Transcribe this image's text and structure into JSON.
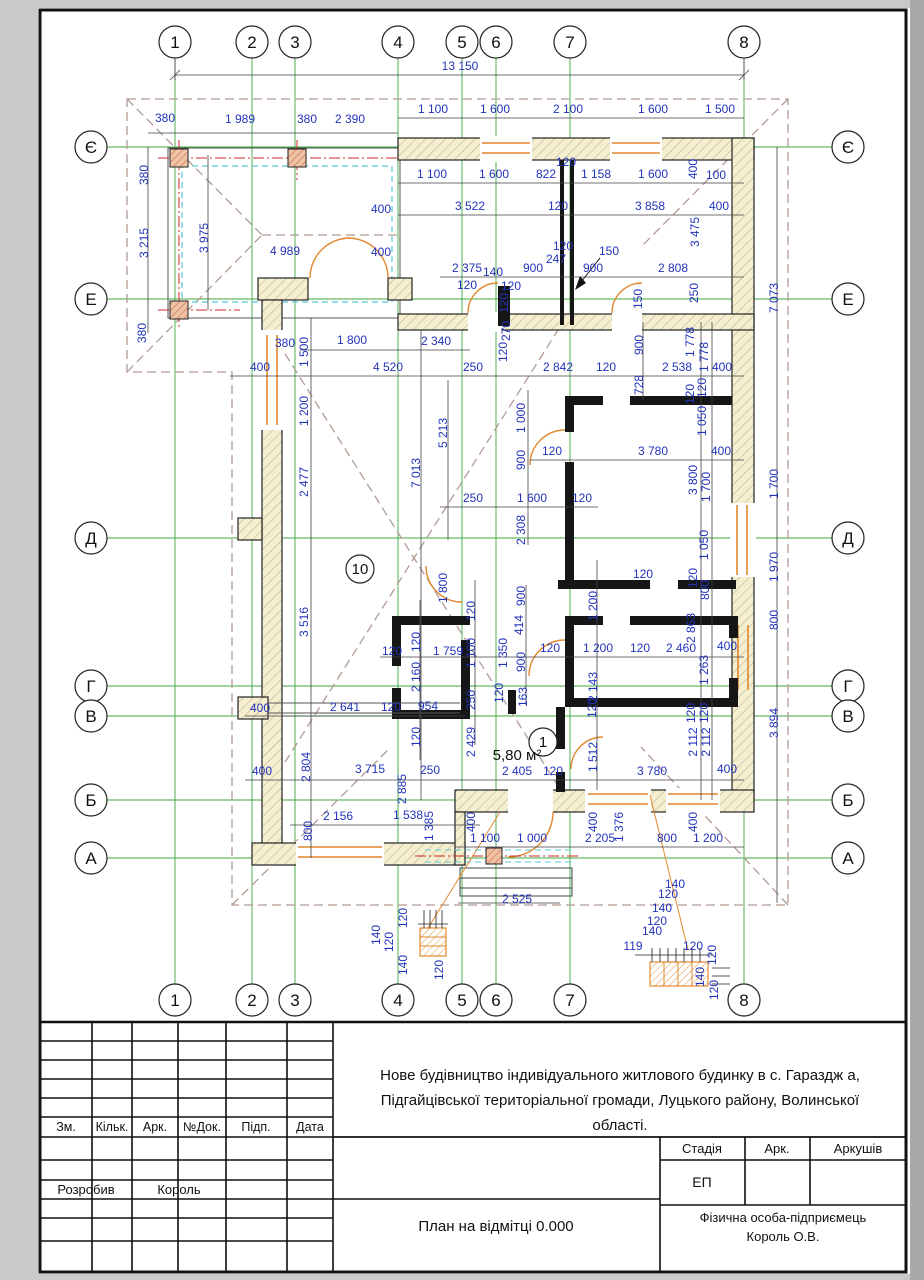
{
  "plan": {
    "colors": {
      "dim": "#2233bb",
      "grid": "#3faa3f",
      "roof_dash": "#b39b94",
      "orange": "#e2882f",
      "cyan": "#5bc8d8",
      "red": "#cc2a2a",
      "wall_fill": "#f6efcf",
      "line": "#222222"
    },
    "axes_x": [
      {
        "label": "1",
        "x": 175
      },
      {
        "label": "2",
        "x": 252
      },
      {
        "label": "3",
        "x": 295
      },
      {
        "label": "4",
        "x": 398
      },
      {
        "label": "5",
        "x": 462
      },
      {
        "label": "6",
        "x": 496
      },
      {
        "label": "7",
        "x": 570
      },
      {
        "label": "8",
        "x": 744
      }
    ],
    "axes_y": [
      {
        "label": "Є",
        "y": 147
      },
      {
        "label": "Е",
        "y": 299
      },
      {
        "label": "Д",
        "y": 538
      },
      {
        "label": "Г",
        "y": 686
      },
      {
        "label": "В",
        "y": 716
      },
      {
        "label": "Б",
        "y": 800
      },
      {
        "label": "А",
        "y": 858
      }
    ],
    "top_circle_y": 42,
    "bottom_circle_y": 1000,
    "left_circle_x": 91,
    "right_circle_x": 848,
    "circle_r": 16,
    "rooms": [
      {
        "num": "10",
        "x": 360,
        "y": 569
      },
      {
        "num": "1",
        "x": 543,
        "y": 742
      }
    ],
    "area_note": {
      "t": "5,80 м²",
      "x": 517,
      "y": 760
    },
    "leader_note": "150",
    "dims": [
      {
        "t": "13 150",
        "x": 460,
        "y": 70
      },
      {
        "t": "380",
        "x": 165,
        "y": 122
      },
      {
        "t": "1 989",
        "x": 240,
        "y": 123
      },
      {
        "t": "380",
        "x": 307,
        "y": 123
      },
      {
        "t": "2 390",
        "x": 350,
        "y": 123
      },
      {
        "t": "1 100",
        "x": 433,
        "y": 113
      },
      {
        "t": "1 600",
        "x": 495,
        "y": 113
      },
      {
        "t": "2 100",
        "x": 568,
        "y": 113
      },
      {
        "t": "1 600",
        "x": 653,
        "y": 113
      },
      {
        "t": "1 500",
        "x": 720,
        "y": 113
      },
      {
        "t": "1 100",
        "x": 432,
        "y": 178
      },
      {
        "t": "1 600",
        "x": 494,
        "y": 178
      },
      {
        "t": "822",
        "x": 546,
        "y": 178
      },
      {
        "t": "120",
        "x": 566,
        "y": 166
      },
      {
        "t": "1 158",
        "x": 596,
        "y": 178
      },
      {
        "t": "1 600",
        "x": 653,
        "y": 178
      },
      {
        "t": "400",
        "x": 697,
        "y": 169,
        "r": 1
      },
      {
        "t": "100",
        "x": 716,
        "y": 179
      },
      {
        "t": "3 522",
        "x": 470,
        "y": 210
      },
      {
        "t": "120",
        "x": 558,
        "y": 210
      },
      {
        "t": "3 858",
        "x": 650,
        "y": 210
      },
      {
        "t": "400",
        "x": 719,
        "y": 210
      },
      {
        "t": "3 475",
        "x": 699,
        "y": 232,
        "r": 1
      },
      {
        "t": "380",
        "x": 148,
        "y": 175,
        "r": 1
      },
      {
        "t": "3 215",
        "x": 148,
        "y": 243,
        "r": 1
      },
      {
        "t": "3 975",
        "x": 208,
        "y": 238,
        "r": 1
      },
      {
        "t": "380",
        "x": 146,
        "y": 333,
        "r": 1
      },
      {
        "t": "4 989",
        "x": 285,
        "y": 255
      },
      {
        "t": "400",
        "x": 381,
        "y": 213
      },
      {
        "t": "400",
        "x": 381,
        "y": 256
      },
      {
        "t": "2 375",
        "x": 467,
        "y": 272
      },
      {
        "t": "140",
        "x": 493,
        "y": 276
      },
      {
        "t": "120",
        "x": 467,
        "y": 289
      },
      {
        "t": "120",
        "x": 511,
        "y": 290
      },
      {
        "t": "900",
        "x": 533,
        "y": 272
      },
      {
        "t": "247",
        "x": 556,
        "y": 263
      },
      {
        "t": "120",
        "x": 563,
        "y": 250
      },
      {
        "t": "150",
        "x": 609,
        "y": 255
      },
      {
        "t": "900",
        "x": 593,
        "y": 272
      },
      {
        "t": "2 808",
        "x": 673,
        "y": 272
      },
      {
        "t": "250",
        "x": 698,
        "y": 293,
        "r": 1
      },
      {
        "t": "150",
        "x": 642,
        "y": 299,
        "r": 1
      },
      {
        "t": "7 073",
        "x": 778,
        "y": 298,
        "r": 1
      },
      {
        "t": "120",
        "x": 508,
        "y": 303,
        "r": 1
      },
      {
        "t": "270",
        "x": 510,
        "y": 331,
        "r": 1
      },
      {
        "t": "120",
        "x": 507,
        "y": 352,
        "r": 1
      },
      {
        "t": "380",
        "x": 285,
        "y": 347
      },
      {
        "t": "1 800",
        "x": 352,
        "y": 344
      },
      {
        "t": "2 340",
        "x": 436,
        "y": 345
      },
      {
        "t": "1 500",
        "x": 308,
        "y": 352,
        "r": 1
      },
      {
        "t": "400",
        "x": 260,
        "y": 371
      },
      {
        "t": "4 520",
        "x": 388,
        "y": 371
      },
      {
        "t": "250",
        "x": 473,
        "y": 371
      },
      {
        "t": "2 842",
        "x": 558,
        "y": 371
      },
      {
        "t": "120",
        "x": 606,
        "y": 371
      },
      {
        "t": "2 538",
        "x": 677,
        "y": 371
      },
      {
        "t": "400",
        "x": 722,
        "y": 371
      },
      {
        "t": "900",
        "x": 643,
        "y": 345,
        "r": 1
      },
      {
        "t": "728",
        "x": 643,
        "y": 385,
        "r": 1
      },
      {
        "t": "1 778",
        "x": 694,
        "y": 342,
        "r": 1
      },
      {
        "t": "1 778",
        "x": 708,
        "y": 357,
        "r": 1
      },
      {
        "t": "1 200",
        "x": 308,
        "y": 411,
        "r": 1
      },
      {
        "t": "2 477",
        "x": 308,
        "y": 482,
        "r": 1
      },
      {
        "t": "1 000",
        "x": 525,
        "y": 418,
        "r": 1
      },
      {
        "t": "900",
        "x": 525,
        "y": 460,
        "r": 1
      },
      {
        "t": "5 213",
        "x": 447,
        "y": 433,
        "r": 1
      },
      {
        "t": "7 013",
        "x": 420,
        "y": 473,
        "r": 1
      },
      {
        "t": "120",
        "x": 694,
        "y": 394,
        "r": 1
      },
      {
        "t": "120",
        "x": 706,
        "y": 388,
        "r": 1
      },
      {
        "t": "1 050",
        "x": 706,
        "y": 421,
        "r": 1
      },
      {
        "t": "120",
        "x": 552,
        "y": 455
      },
      {
        "t": "3 780",
        "x": 653,
        "y": 455
      },
      {
        "t": "400",
        "x": 721,
        "y": 455
      },
      {
        "t": "3 800",
        "x": 697,
        "y": 480,
        "r": 1
      },
      {
        "t": "1 700",
        "x": 710,
        "y": 487,
        "r": 1
      },
      {
        "t": "1 700",
        "x": 778,
        "y": 484,
        "r": 1
      },
      {
        "t": "250",
        "x": 473,
        "y": 502
      },
      {
        "t": "1 600",
        "x": 532,
        "y": 502
      },
      {
        "t": "120",
        "x": 582,
        "y": 502
      },
      {
        "t": "2 308",
        "x": 525,
        "y": 530,
        "r": 1
      },
      {
        "t": "1 050",
        "x": 708,
        "y": 545,
        "r": 1
      },
      {
        "t": "1 970",
        "x": 778,
        "y": 567,
        "r": 1
      },
      {
        "t": "120",
        "x": 697,
        "y": 578,
        "r": 1
      },
      {
        "t": "800",
        "x": 709,
        "y": 590,
        "r": 1
      },
      {
        "t": "3 516",
        "x": 308,
        "y": 622,
        "r": 1
      },
      {
        "t": "1 800",
        "x": 447,
        "y": 588,
        "r": 1
      },
      {
        "t": "120",
        "x": 475,
        "y": 611,
        "r": 1
      },
      {
        "t": "900",
        "x": 525,
        "y": 596,
        "r": 1
      },
      {
        "t": "1 200",
        "x": 597,
        "y": 606,
        "r": 1
      },
      {
        "t": "120",
        "x": 643,
        "y": 578
      },
      {
        "t": "800",
        "x": 778,
        "y": 620,
        "r": 1
      },
      {
        "t": "2 863",
        "x": 695,
        "y": 628,
        "r": 1
      },
      {
        "t": "414",
        "x": 523,
        "y": 625,
        "r": 1
      },
      {
        "t": "1 350",
        "x": 507,
        "y": 653,
        "r": 1
      },
      {
        "t": "900",
        "x": 525,
        "y": 662,
        "r": 1
      },
      {
        "t": "1 100",
        "x": 475,
        "y": 653,
        "r": 1
      },
      {
        "t": "120",
        "x": 420,
        "y": 642,
        "r": 1
      },
      {
        "t": "1 759",
        "x": 448,
        "y": 655
      },
      {
        "t": "120",
        "x": 392,
        "y": 655
      },
      {
        "t": "2 160",
        "x": 420,
        "y": 677,
        "r": 1
      },
      {
        "t": "120",
        "x": 550,
        "y": 652
      },
      {
        "t": "1 200",
        "x": 598,
        "y": 652
      },
      {
        "t": "120",
        "x": 640,
        "y": 652
      },
      {
        "t": "2 460",
        "x": 681,
        "y": 652
      },
      {
        "t": "400",
        "x": 727,
        "y": 650
      },
      {
        "t": "1 263",
        "x": 708,
        "y": 670,
        "r": 1
      },
      {
        "t": "163",
        "x": 527,
        "y": 697,
        "r": 1
      },
      {
        "t": "120",
        "x": 503,
        "y": 693,
        "r": 1
      },
      {
        "t": "250",
        "x": 475,
        "y": 700,
        "r": 1
      },
      {
        "t": "2 143",
        "x": 597,
        "y": 687,
        "r": 1
      },
      {
        "t": "120",
        "x": 596,
        "y": 708,
        "r": 1
      },
      {
        "t": "400",
        "x": 260,
        "y": 712
      },
      {
        "t": "2 641",
        "x": 345,
        "y": 711
      },
      {
        "t": "120",
        "x": 391,
        "y": 711
      },
      {
        "t": "954",
        "x": 428,
        "y": 710
      },
      {
        "t": "120",
        "x": 695,
        "y": 713,
        "r": 1
      },
      {
        "t": "120",
        "x": 708,
        "y": 713,
        "r": 1
      },
      {
        "t": "120",
        "x": 420,
        "y": 737,
        "r": 1
      },
      {
        "t": "2 429",
        "x": 475,
        "y": 742,
        "r": 1
      },
      {
        "t": "1 512",
        "x": 597,
        "y": 757,
        "r": 1
      },
      {
        "t": "2 112",
        "x": 697,
        "y": 742,
        "r": 1
      },
      {
        "t": "2 112",
        "x": 710,
        "y": 742,
        "r": 1
      },
      {
        "t": "3 894",
        "x": 778,
        "y": 723,
        "r": 1
      },
      {
        "t": "2 804",
        "x": 310,
        "y": 767,
        "r": 1
      },
      {
        "t": "400",
        "x": 262,
        "y": 775
      },
      {
        "t": "3 715",
        "x": 370,
        "y": 773
      },
      {
        "t": "250",
        "x": 430,
        "y": 774
      },
      {
        "t": "2 885",
        "x": 406,
        "y": 789,
        "r": 1
      },
      {
        "t": "2 405",
        "x": 517,
        "y": 775
      },
      {
        "t": "120",
        "x": 553,
        "y": 775
      },
      {
        "t": "3 780",
        "x": 652,
        "y": 775
      },
      {
        "t": "400",
        "x": 727,
        "y": 773
      },
      {
        "t": "2 156",
        "x": 338,
        "y": 820
      },
      {
        "t": "1 538",
        "x": 408,
        "y": 819
      },
      {
        "t": "1 385",
        "x": 433,
        "y": 826,
        "r": 1
      },
      {
        "t": "800",
        "x": 312,
        "y": 831,
        "r": 1
      },
      {
        "t": "400",
        "x": 475,
        "y": 822,
        "r": 1
      },
      {
        "t": "1 100",
        "x": 485,
        "y": 842
      },
      {
        "t": "1 000",
        "x": 532,
        "y": 842
      },
      {
        "t": "400",
        "x": 597,
        "y": 822,
        "r": 1
      },
      {
        "t": "2 205",
        "x": 600,
        "y": 842
      },
      {
        "t": "1 376",
        "x": 623,
        "y": 827,
        "r": 1
      },
      {
        "t": "800",
        "x": 667,
        "y": 842
      },
      {
        "t": "400",
        "x": 697,
        "y": 822,
        "r": 1
      },
      {
        "t": "1 200",
        "x": 708,
        "y": 842
      },
      {
        "t": "2 525",
        "x": 517,
        "y": 903
      },
      {
        "t": "120",
        "x": 407,
        "y": 918,
        "r": 1
      },
      {
        "t": "140",
        "x": 380,
        "y": 935,
        "r": 1
      },
      {
        "t": "120",
        "x": 393,
        "y": 942,
        "r": 1
      },
      {
        "t": "140",
        "x": 407,
        "y": 965,
        "r": 1
      },
      {
        "t": "120",
        "x": 443,
        "y": 970,
        "r": 1
      },
      {
        "t": "140",
        "x": 675,
        "y": 888
      },
      {
        "t": "120",
        "x": 668,
        "y": 898
      },
      {
        "t": "140",
        "x": 662,
        "y": 912
      },
      {
        "t": "120",
        "x": 657,
        "y": 925
      },
      {
        "t": "140",
        "x": 652,
        "y": 935
      },
      {
        "t": "119",
        "x": 633,
        "y": 950
      },
      {
        "t": "120",
        "x": 693,
        "y": 950
      },
      {
        "t": "120",
        "x": 716,
        "y": 955,
        "r": 1
      },
      {
        "t": "140",
        "x": 704,
        "y": 977,
        "r": 1
      },
      {
        "t": "120",
        "x": 718,
        "y": 990,
        "r": 1
      }
    ]
  },
  "titleblock": {
    "headers": [
      "Зм.",
      "Кільк.",
      "Арк.",
      "№Док.",
      "Підп.",
      "Дата"
    ],
    "developed_label": "Розробив",
    "developed_value": "Король",
    "project_line1": "Нове будівництво індивідуального житлового будинку в с. Гараздж а,",
    "project_line2": "Підгайцівської територіальної громади, Луцького району, Волинської",
    "project_line3": "області.",
    "stage_label": "Стадія",
    "sheet_label": "Арк.",
    "sheets_label": "Аркушів",
    "stage_value": "ЕП",
    "drawing_title": "План на відмітці 0.000",
    "company_line1": "Фізична особа-підприємець",
    "company_line2": "Король О.В."
  }
}
